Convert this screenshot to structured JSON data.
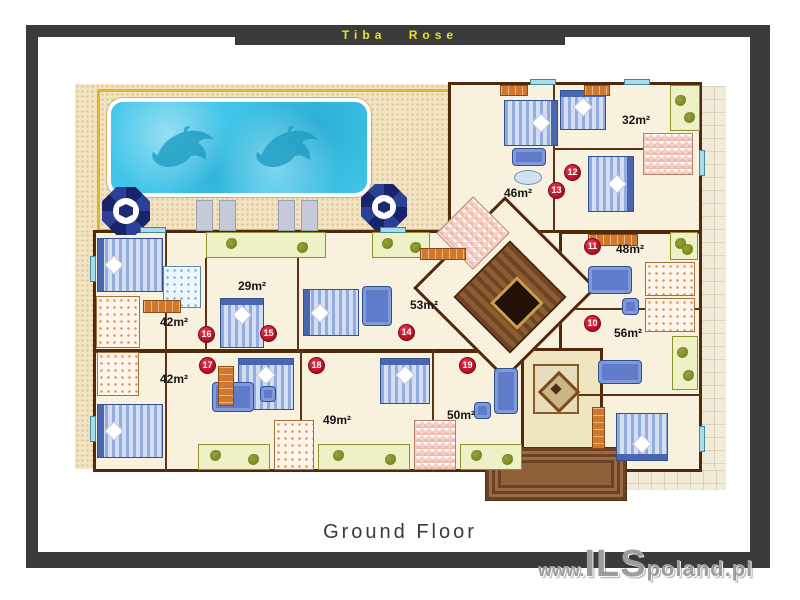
{
  "header": {
    "title": "Tiba Rose"
  },
  "footer": {
    "floor_label": "Ground Floor"
  },
  "watermark": {
    "prefix": "www.",
    "brand": "ILS",
    "suffix": "poland.pl"
  },
  "rooms": [
    {
      "name": "room-32",
      "area": "32m²"
    },
    {
      "name": "room-46",
      "area": "46m²"
    },
    {
      "name": "room-48",
      "area": "48m²"
    },
    {
      "name": "room-56",
      "area": "56m²"
    },
    {
      "name": "room-29",
      "area": "29m²"
    },
    {
      "name": "room-42-upper",
      "area": "42m²"
    },
    {
      "name": "room-53",
      "area": "53m²"
    },
    {
      "name": "room-42-lower",
      "area": "42m²"
    },
    {
      "name": "room-49",
      "area": "49m²"
    },
    {
      "name": "room-50",
      "area": "50m²"
    }
  ],
  "markers": [
    {
      "number": "10"
    },
    {
      "number": "11"
    },
    {
      "number": "12"
    },
    {
      "number": "13"
    },
    {
      "number": "14"
    },
    {
      "number": "15"
    },
    {
      "number": "16"
    },
    {
      "number": "17"
    },
    {
      "number": "18"
    },
    {
      "number": "19"
    }
  ],
  "icons": {
    "umbrella": "octagonal pool parasol, top view",
    "dolphin": "dolphin silhouette mosaic in pool",
    "sun_lounger": "sun lounger, top view",
    "stairs": "central staircase with elevator shaft",
    "entrance_steps": "entrance stairway"
  },
  "colors": {
    "frame": "#3b3b3b",
    "title_text": "#e6e22e",
    "wall": "#53290e",
    "floor": "#f8f1de",
    "pool_water": "#41c5e9",
    "deck": "#f2e4c2",
    "marker": "#b30d22",
    "balcony": "#eef0c6",
    "stairs": "#8d5c33",
    "watermark": "#9d9d9d"
  }
}
